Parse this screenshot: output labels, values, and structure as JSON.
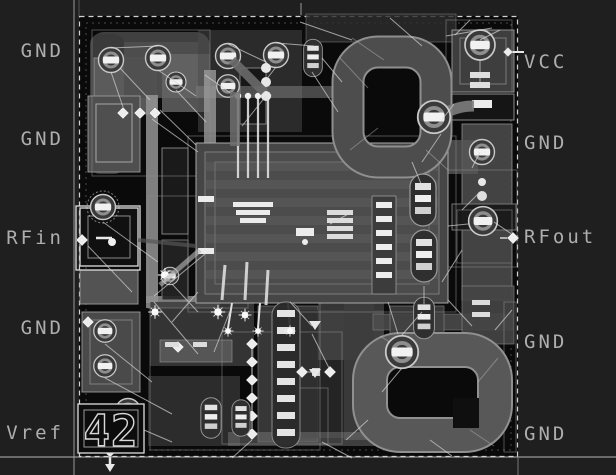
{
  "figure": {
    "description": "MMIC amplifier die layout view",
    "die_marking": "42"
  },
  "ports": {
    "left": [
      {
        "label": "GND",
        "y": 51
      },
      {
        "label": "GND",
        "y": 139
      },
      {
        "label": "RFin",
        "y": 238
      },
      {
        "label": "GND",
        "y": 328
      },
      {
        "label": "Vref",
        "y": 433
      }
    ],
    "right": [
      {
        "label": "VCC",
        "y": 62
      },
      {
        "label": "GND",
        "y": 143
      },
      {
        "label": "RFout",
        "y": 237
      },
      {
        "label": "GND",
        "y": 342
      },
      {
        "label": "GND",
        "y": 434
      }
    ]
  },
  "colors": {
    "background": "#1f1f1f",
    "die_background": "#0a0a0a",
    "metal_mid": "#4a4a4a",
    "metal_light": "#8f8f8f",
    "metal_bright": "#efefef",
    "boundary_outline": "#d2d2d2",
    "label_text": "#aeaeae"
  }
}
